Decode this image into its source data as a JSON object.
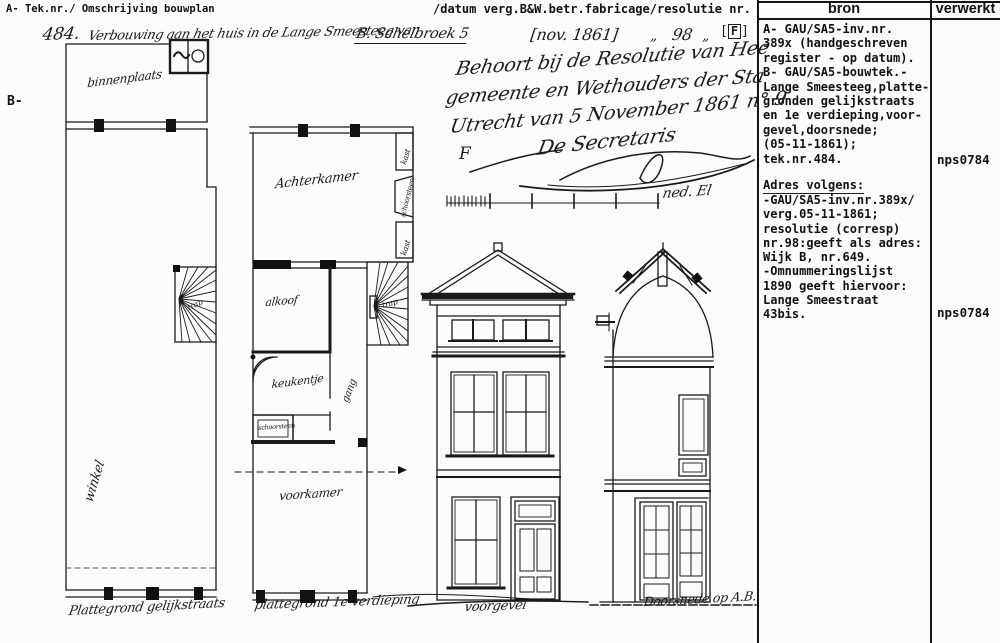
{
  "header": {
    "left": "A- Tek.nr./ Omschrijving bouwplan",
    "right": "/datum verg.B&W.betr.fabricage/resolutie nr.",
    "col_bron": "bron",
    "col_verwerkt": "verwerkt",
    "margin_label": "B-"
  },
  "title_line": {
    "number": "484.",
    "description": "Verbouwing aan het huis in de Lange Smeesteeg van",
    "name": "B. Schelbroek 5",
    "date": "[nov. 1861]",
    "ditto_left": "„",
    "resolutie_nr": "98",
    "ditto_right": "„",
    "flag": "F"
  },
  "note": {
    "line1": "Behoort bij de Resolutie van Hee",
    "line2": "gemeente en Wethouders der Sta",
    "line3": "Utrecht van 5 November 1861 n° 9",
    "line4": "F",
    "line5": "De Secretaris"
  },
  "scalebar": {
    "unit_label": "ned. El"
  },
  "drawings": {
    "plan_ground": {
      "caption": "Plattegrond gelijkstraats",
      "rooms": {
        "binnenplaats": "binnenplaats",
        "winkel": "winkel",
        "trap": "trap"
      }
    },
    "plan_first": {
      "caption": "plattegrond 1e verdieping",
      "rooms": {
        "achterkamer": "Achterkamer",
        "kast_boven": "kast",
        "schoorsteen_rechts": "schoorsteen",
        "kast_onder": "kast",
        "alkoof": "alkoof",
        "trap": "trap",
        "keukentje": "keukentje",
        "gang": "gang",
        "schoorsteen_onder": "schoorsteen",
        "voorkamer": "voorkamer"
      }
    },
    "elevation": {
      "caption": "voorgevel"
    },
    "section": {
      "caption": "Doorsnede op A.B."
    }
  },
  "bron": {
    "block1": "A- GAU/SA5-inv.nr.\n389x (handgeschreven\nregister - op datum).\nB- GAU/SA5-bouwtek.-\nLange Smeesteeg,platte-\n gronden gelijkstraats\nen 1e verdieping,voor-\ngevel,doorsnede;\n(05-11-1861);\ntek.nr.484.",
    "adres_heading": "Adres volgens:",
    "block2": "-GAU/SA5-inv.nr.389x/\nverg.05-11-1861;\n resolutie (corresp)\n nr.98:geeft als adres:\nWijk B, nr.649.\n-Omnummeringslijst\n1890 geeft hiervoor:\n Lange Smeestraat\n 43bis."
  },
  "verwerkt": {
    "code1": "nps0784",
    "code2": "nps0784"
  }
}
